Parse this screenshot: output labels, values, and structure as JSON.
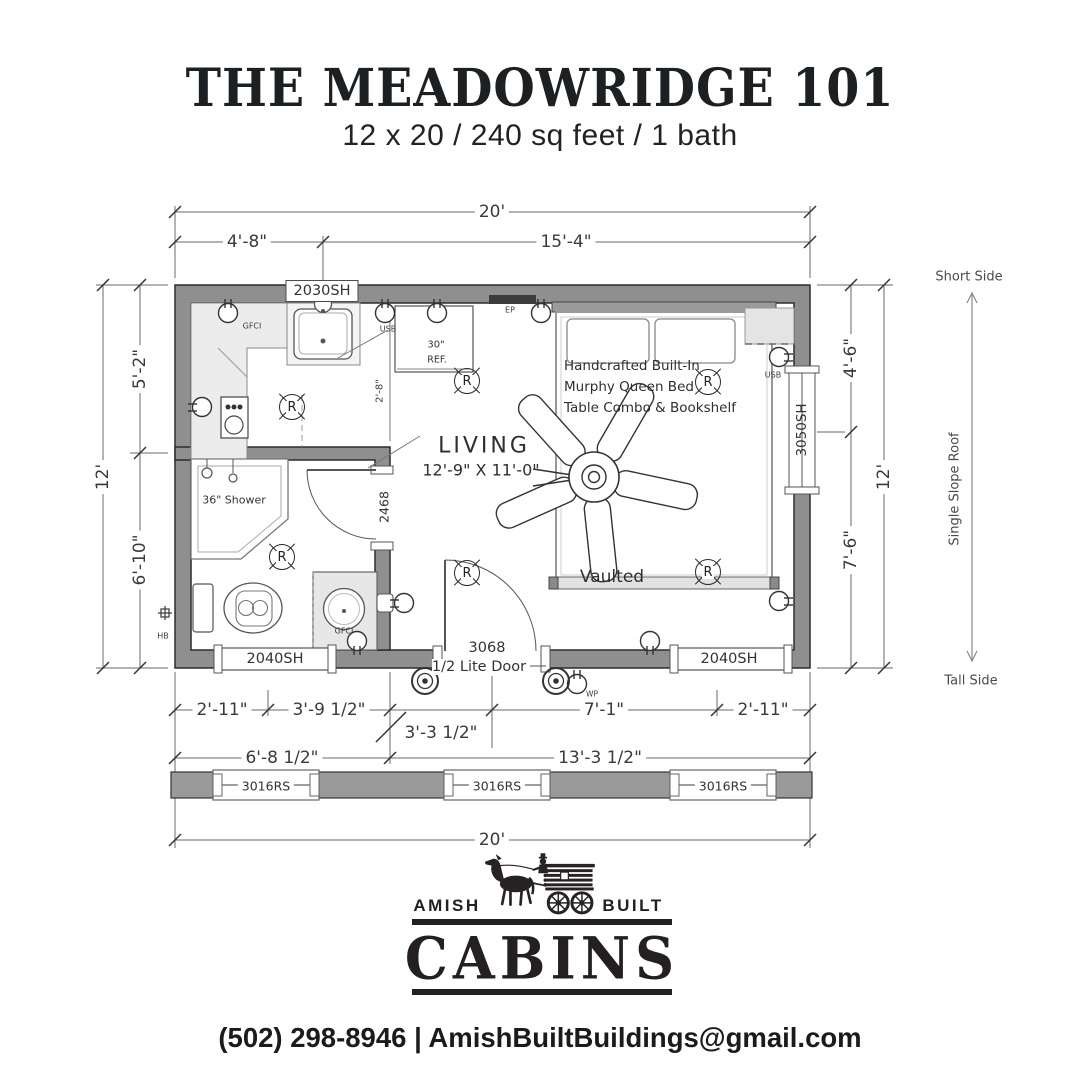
{
  "colors": {
    "wall_gray": "#8f8f8f",
    "ink": "#2d2d2d",
    "logo_black": "#272324"
  },
  "header": {
    "title": "THE MEADOWRIDGE 101",
    "subtitle": "12 x 20 / 240 sq feet / 1 bath"
  },
  "plan": {
    "dimensions": {
      "top_total": "20'",
      "top_left": "4'-8\"",
      "top_right": "15'-4\"",
      "left_total": "12'",
      "left_upper": "5'-2\"",
      "left_lower": "6'-10\"",
      "right_upper": "4'-6\"",
      "right_lower": "7'-6\"",
      "right_total": "12'",
      "bottom_r1_1": "2'-11\"",
      "bottom_r1_2": "3'-9 1/2\"",
      "bottom_r1_3": "3'-3 1/2\"",
      "bottom_r1_4": "7'-1\"",
      "bottom_r1_5": "2'-11\"",
      "bottom_r2_1": "6'-8 1/2\"",
      "bottom_r2_2": "13'-3 1/2\"",
      "bottom_total": "20'",
      "counter_depth": "2'-8\""
    },
    "windows": {
      "top": "2030SH",
      "right": "3050SH",
      "bottom_left": "2040SH",
      "bottom_right": "2040SH",
      "rear_1": "3016RS",
      "rear_2": "3016RS",
      "rear_3": "3016RS"
    },
    "doors": {
      "bath": "2468",
      "front_no": "3068",
      "front_type": "1/2 Lite Door"
    },
    "rooms": {
      "living": "LIVING",
      "living_dims": "12'-9\" X 11'-0\"",
      "vaulted": "Vaulted",
      "shower": "36\" Shower",
      "fridge_1": "30\"",
      "fridge_2": "REF."
    },
    "bed_note": {
      "line1": "Handcrafted Built-In",
      "line2": "Murphy Queen Bed",
      "line3": "Table Combo & Bookshelf"
    },
    "electrical": {
      "gfci_kitchen": "GFCI",
      "usb_kitchen": "USB",
      "ep": "EP",
      "usb_right": "USB",
      "gfci_bath": "GFCI",
      "wp": "WP",
      "hb": "HB"
    },
    "symbols": {
      "recessed_light": "R"
    },
    "roof": {
      "short": "Short Side",
      "slope": "Single Slope Roof",
      "tall": "Tall Side"
    }
  },
  "footer": {
    "brand_left": "AMISH",
    "brand_right": "BUILT",
    "brand_main": "CABINS",
    "contact": "(502) 298-8946 | AmishBuiltBuildings@gmail.com"
  }
}
